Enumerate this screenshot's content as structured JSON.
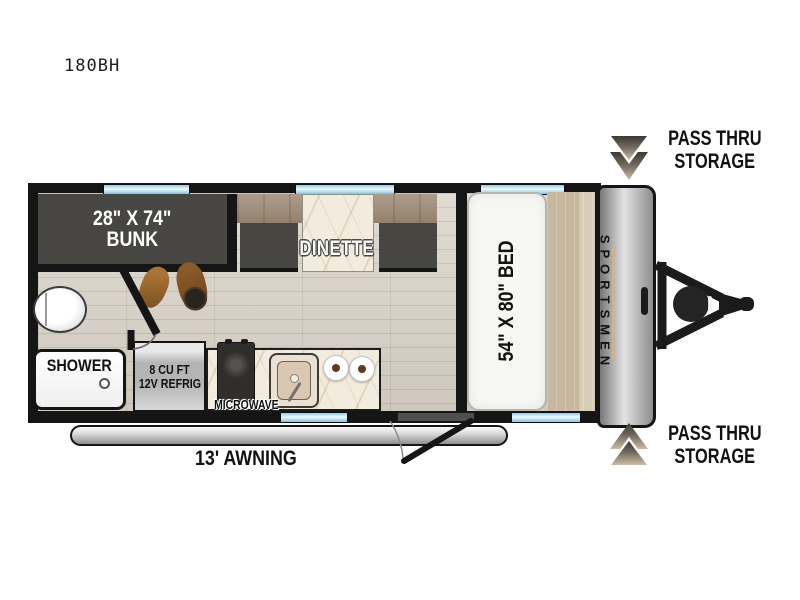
{
  "model_label": "180BH",
  "areas": {
    "bunk": {
      "size": "28\" X 74\"",
      "name": "BUNK"
    },
    "dinette": {
      "name": "DINETTE"
    },
    "bed": {
      "size_label": "54\" X 80\" BED"
    },
    "shower": {
      "name": "SHOWER"
    },
    "refrigerator": {
      "line1": "8 CU FT",
      "line2": "12V REFRIG"
    },
    "microwave": {
      "name": "MICROWAVE"
    },
    "awning": {
      "name": "13' AWNING"
    },
    "brand": {
      "name": "SPORTSMEN"
    }
  },
  "storage": {
    "front_top": {
      "line1": "PASS THRU",
      "line2": "STORAGE",
      "icon": "double-chevron-down"
    },
    "front_bottom": {
      "line1": "PASS THRU",
      "line2": "STORAGE",
      "icon": "double-chevron-up"
    }
  },
  "colors": {
    "wall": "#151515",
    "furniture": "#474643",
    "floor": "#d6d0c4",
    "marble": "#f2ecdf",
    "window_blue": "#8ccbec",
    "platform_tan": "#c6b79e",
    "arrow_bronze": "#cdbca3",
    "cap_gray": "#8d8d8d"
  }
}
